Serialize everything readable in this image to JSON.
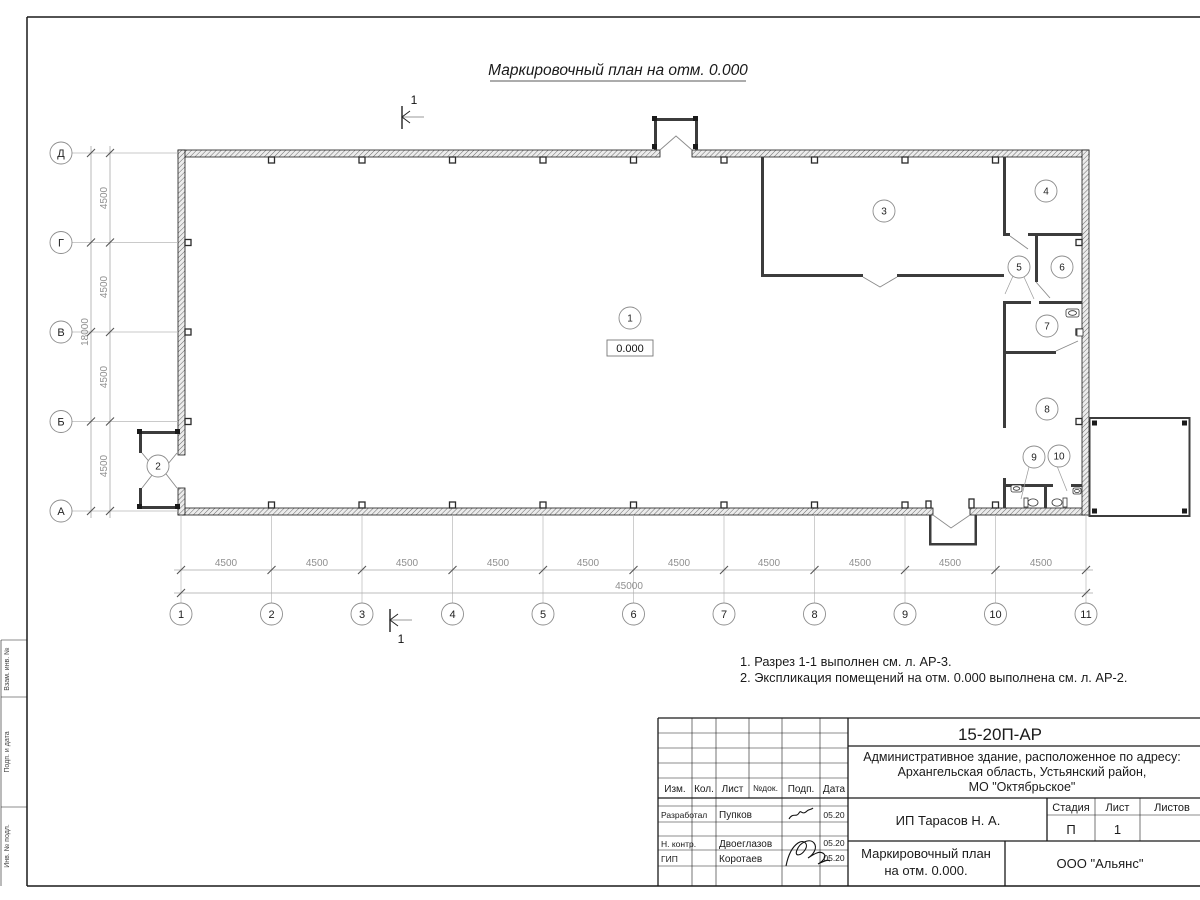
{
  "page": {
    "title": "Маркировочный план на отм. 0.000"
  },
  "section_marks": {
    "top": "1",
    "bottom": "1"
  },
  "axes": {
    "vertical": [
      "Д",
      "Г",
      "В",
      "Б",
      "А"
    ],
    "horizontal": [
      "1",
      "2",
      "3",
      "4",
      "5",
      "6",
      "7",
      "8",
      "9",
      "10",
      "11"
    ]
  },
  "dimensions": {
    "left_spacings": [
      "4500",
      "4500",
      "4500",
      "4500"
    ],
    "left_total": "18000",
    "bottom_spacings": [
      "4500",
      "4500",
      "4500",
      "4500",
      "4500",
      "4500",
      "4500",
      "4500",
      "4500",
      "4500"
    ],
    "bottom_total": "45000"
  },
  "rooms": [
    "1",
    "2",
    "3",
    "4",
    "5",
    "6",
    "7",
    "8",
    "9",
    "10"
  ],
  "elevation_mark": "0.000",
  "notes": [
    "1. Разрез 1-1 выполнен см. л. АР-3.",
    "2. Экспликация помещений на отм. 0.000 выполнена см. л. АР-2."
  ],
  "title_block": {
    "doc_number": "15-20П-АР",
    "project_address": [
      "Административное здание, расположенное по адресу:",
      "Архангельская область, Устьянский район,",
      "МО \"Октябрьское\""
    ],
    "columns": {
      "izm": "Изм.",
      "kol": "Кол.",
      "list": "Лист",
      "ndok": "№док.",
      "podp": "Подп.",
      "data": "Дата"
    },
    "rows": [
      {
        "role": "Разработал",
        "name": "Пупков",
        "date": "05.20"
      },
      {
        "role": "Н. контр.",
        "name": "Двоеглазов",
        "date": "05.20"
      },
      {
        "role": "ГИП",
        "name": "Коротаев",
        "date": "05.20"
      }
    ],
    "client": "ИП Тарасов Н. А.",
    "stage_header": "Стадия",
    "sheet_header": "Лист",
    "sheets_header": "Листов",
    "stage": "П",
    "sheet": "1",
    "drawing_name": [
      "Маркировочный план",
      "на отм. 0.000."
    ],
    "organization": "ООО \"Альянс\""
  },
  "side_stamp": [
    "Взам. инв. №",
    "Подп. и дата",
    "Инв. № подл."
  ]
}
